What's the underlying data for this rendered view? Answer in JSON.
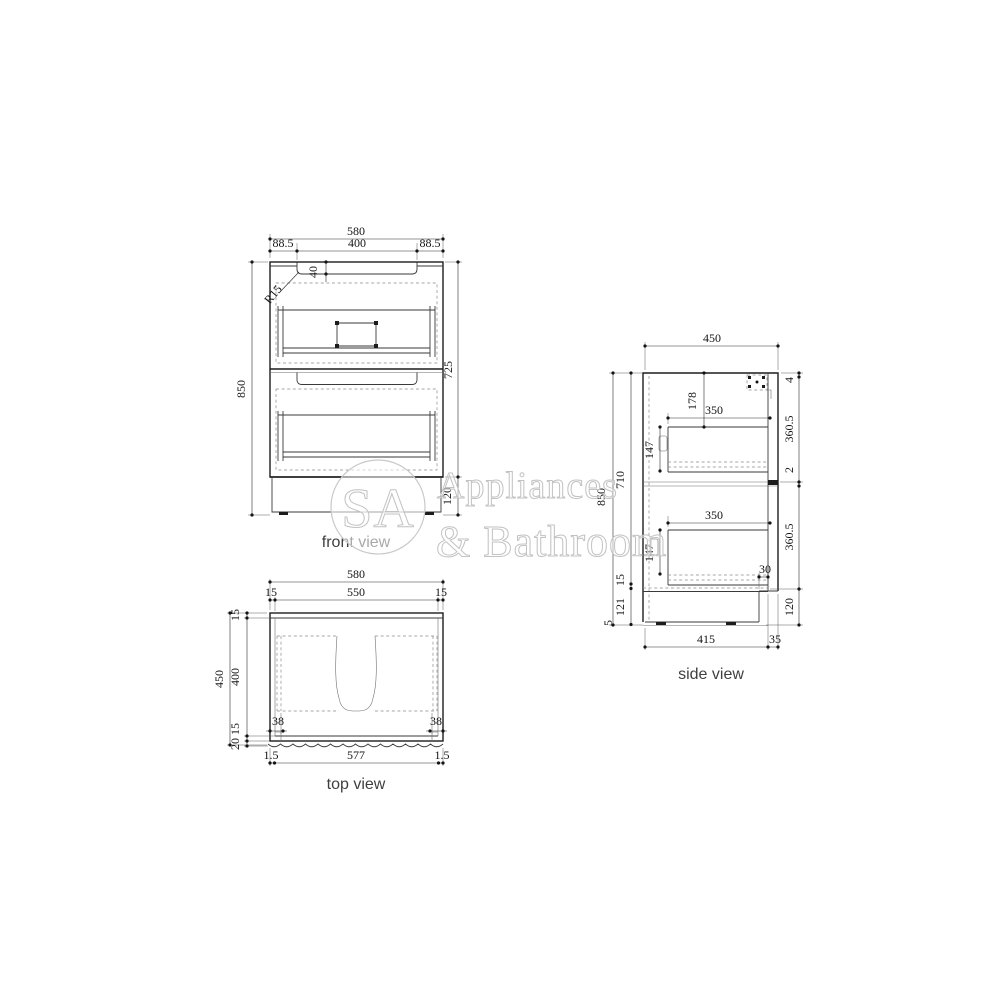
{
  "watermark": {
    "initials": "SA",
    "line1": "Appliances",
    "line2": "& Bathroom"
  },
  "front_view": {
    "label": "front view",
    "dims": {
      "overall_width": "580",
      "left_margin": "88.5",
      "handle_width": "400",
      "right_margin": "88.5",
      "handle_depth": "40",
      "corner_radius": "R15",
      "overall_height": "850",
      "body_height": "725",
      "kick_height": "120"
    }
  },
  "side_view": {
    "label": "side view",
    "dims": {
      "overall_depth": "450",
      "top_to_drawer": "178",
      "drawer_depth_top": "350",
      "drawer_front_top": "147",
      "drawer_depth_bottom": "350",
      "drawer_front_bottom": "147",
      "top_panel": "4",
      "upper_front": "360.5",
      "front_gap": "2",
      "lower_front": "360.5",
      "kick_recess": "30",
      "kick_height": "120",
      "overall_height": "850",
      "carcass_height": "710",
      "bottom_panel": "15",
      "plinth_height": "121",
      "floor_gap": "5",
      "base_depth": "415",
      "front_offset": "35"
    }
  },
  "top_view": {
    "label": "top view",
    "dims": {
      "overall_width": "580",
      "panel_left": "15",
      "inner_width": "550",
      "panel_right": "15",
      "overall_depth": "450",
      "back_panel": "15",
      "inner_depth": "400",
      "front_panel": "15",
      "front_lip": "20",
      "offset_left": "38",
      "offset_right": "38",
      "edge_left": "1.5",
      "front_width": "577",
      "edge_right": "1.5"
    }
  }
}
